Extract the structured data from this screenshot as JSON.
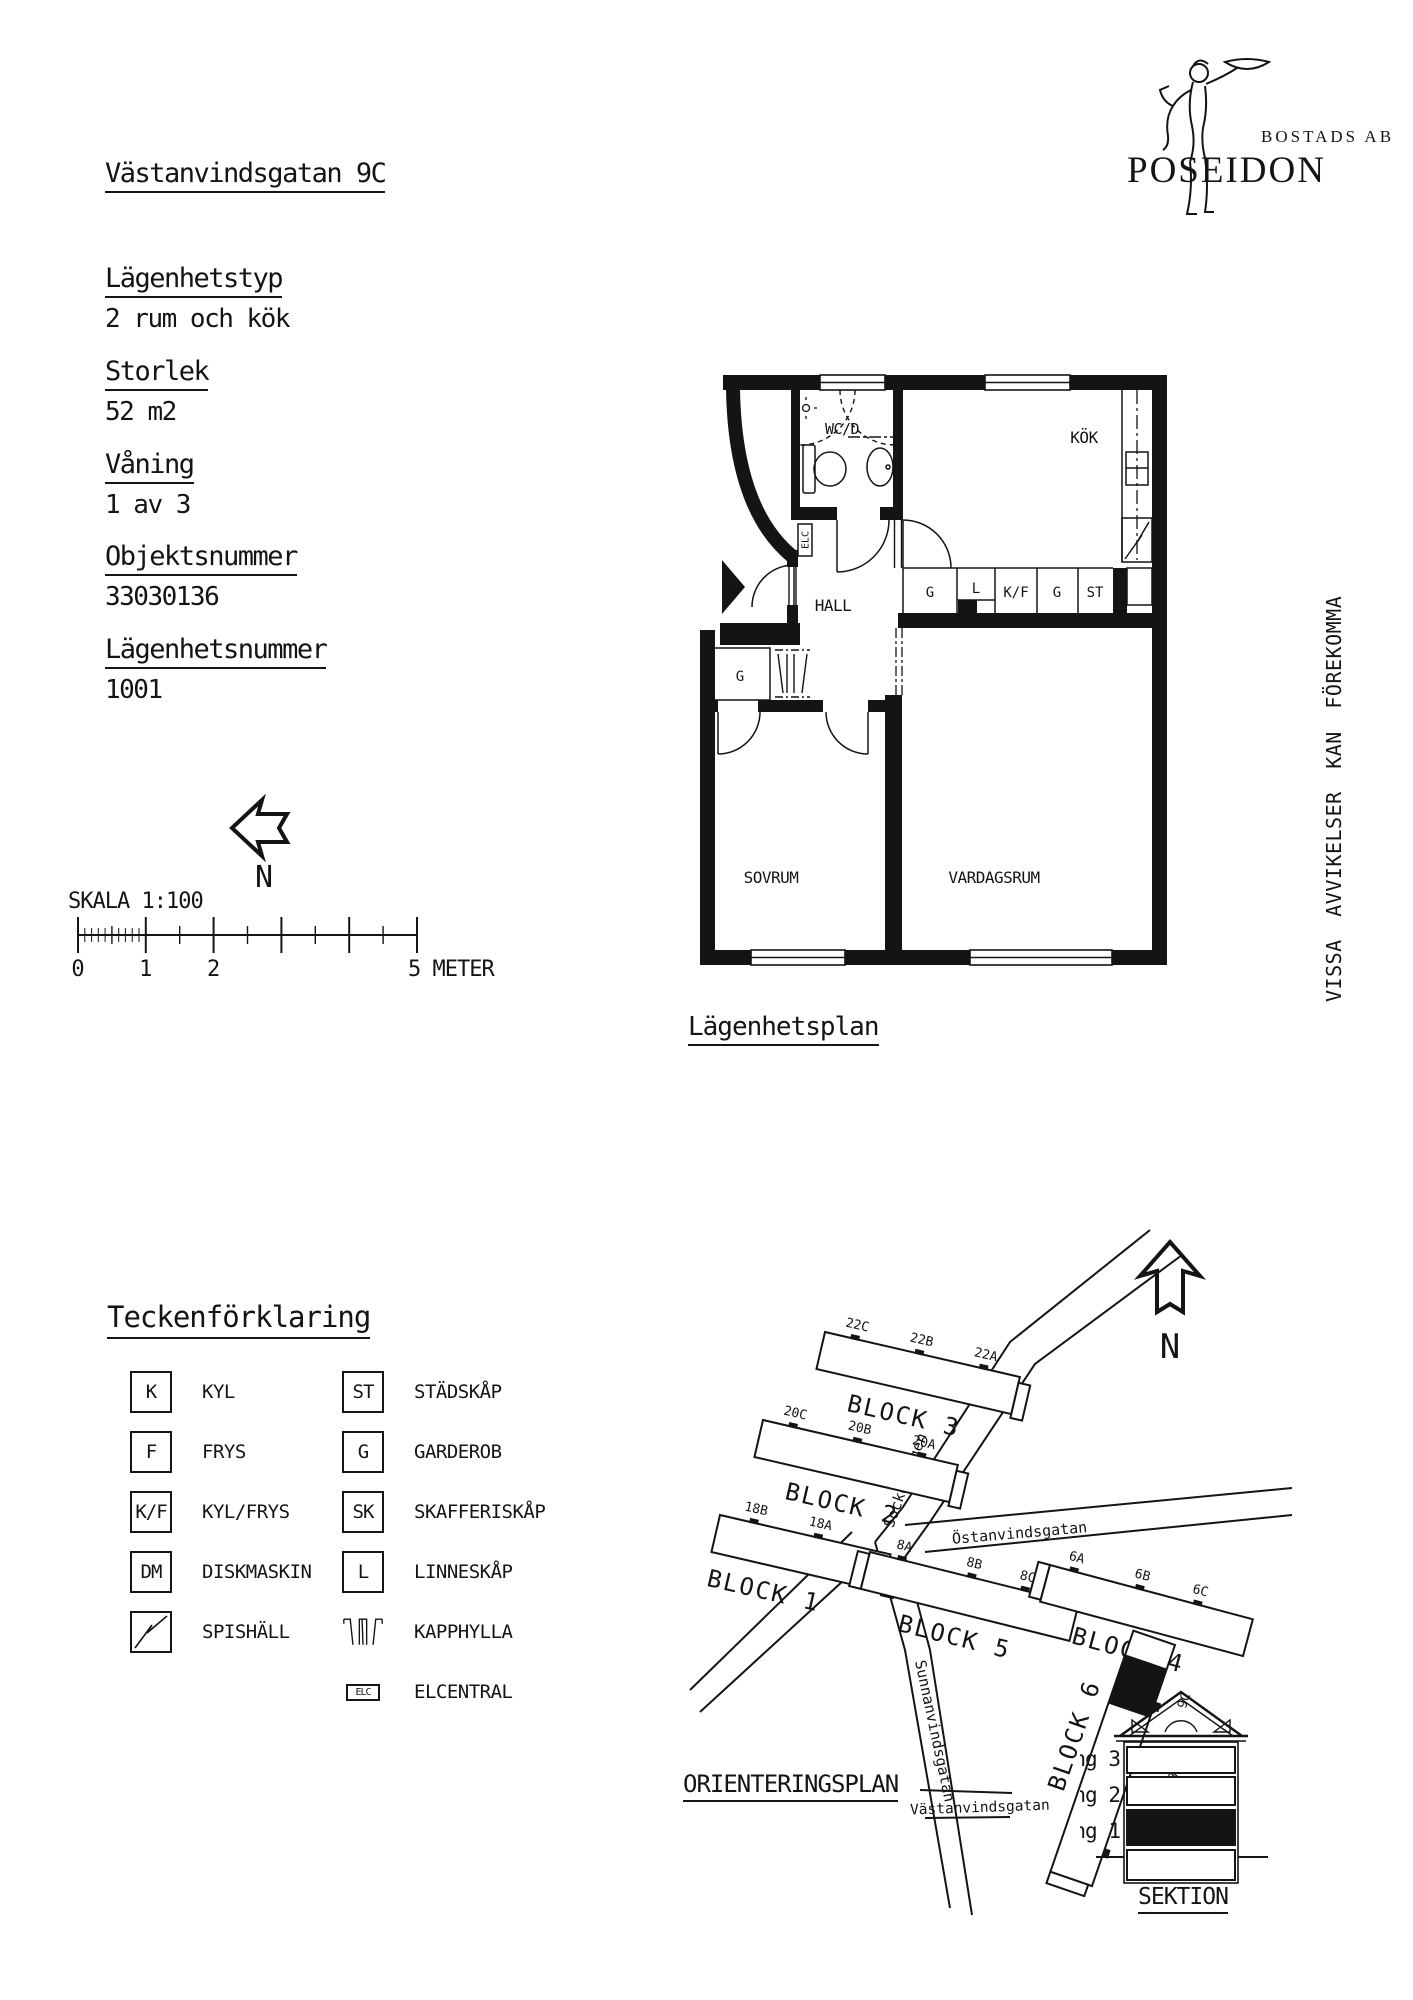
{
  "header": {
    "address": "Västanvindsgatan 9C"
  },
  "logo": {
    "line1": "BOSTADS AB",
    "line2": "POSEIDON"
  },
  "info": {
    "fields": [
      {
        "label": "Lägenhetstyp",
        "value": "2 rum och kök"
      },
      {
        "label": "Storlek",
        "value": "52 m2"
      },
      {
        "label": "Våning",
        "value": "1 av 3"
      },
      {
        "label": "Objektsnummer",
        "value": "33030136"
      },
      {
        "label": "Lägenhetsnummer",
        "value": "1001"
      }
    ]
  },
  "plan": {
    "caption": "Lägenhetsplan",
    "note": "VISSA AVVIKELSER KAN FÖREKOMMA",
    "rooms": {
      "wc": "WC/D",
      "kitchen": "KÖK",
      "hall": "HALL",
      "bedroom": "SOVRUM",
      "living": "VARDAGSRUM"
    },
    "closets": {
      "c1": "G",
      "c2": "L",
      "c3": "K/F",
      "c4": "G",
      "c5": "ST",
      "hall_g": "G",
      "elc": "ELC"
    }
  },
  "scale": {
    "label": "SKALA 1:100",
    "north": "N",
    "tick0": "0",
    "tick1": "1",
    "tick2": "2",
    "tick_end": "5 METER"
  },
  "legend": {
    "title": "Teckenförklaring",
    "left": [
      {
        "key": "K",
        "label": "KYL"
      },
      {
        "key": "F",
        "label": "FRYS"
      },
      {
        "key": "K/F",
        "label": "KYL/FRYS"
      },
      {
        "key": "DM",
        "label": "DISKMASKIN"
      },
      {
        "key": "",
        "label": "SPISHÄLL"
      }
    ],
    "right": [
      {
        "key": "ST",
        "label": "STÄDSKÅP"
      },
      {
        "key": "G",
        "label": "GARDEROB"
      },
      {
        "key": "SK",
        "label": "SKAFFERISKÅP"
      },
      {
        "key": "L",
        "label": "LINNESKÅP"
      },
      {
        "key": "",
        "label": "KAPPHYLLA"
      },
      {
        "key": "ELC",
        "label": "ELCENTRAL"
      }
    ]
  },
  "map": {
    "caption": "ORIENTERINGSPLAN",
    "north": "N",
    "blocks": [
      {
        "name": "BLOCK 3",
        "entrances": [
          "22C",
          "22B",
          "22A"
        ]
      },
      {
        "name": "BLOCK 2",
        "entrances": [
          "20C",
          "20B",
          "20A"
        ]
      },
      {
        "name": "BLOCK 1",
        "entrances": [
          "18B",
          "18A"
        ]
      },
      {
        "name": "BLOCK 5",
        "entrances": [
          "8A",
          "8B",
          "8C"
        ]
      },
      {
        "name": "BLOCK 4",
        "entrances": [
          "6A",
          "6B",
          "6C"
        ]
      },
      {
        "name": "BLOCK 6",
        "entrances": [
          "9C",
          "9B",
          "9A"
        ]
      }
    ],
    "streets": [
      "Sockenvägen",
      "Östanvindsgatan",
      "Sunnanvindsgatan",
      "Västanvindsgatan"
    ]
  },
  "sektion": {
    "caption": "SEKTION",
    "floors": [
      "Våning 3",
      "Våning 2",
      "Våning 1"
    ]
  }
}
